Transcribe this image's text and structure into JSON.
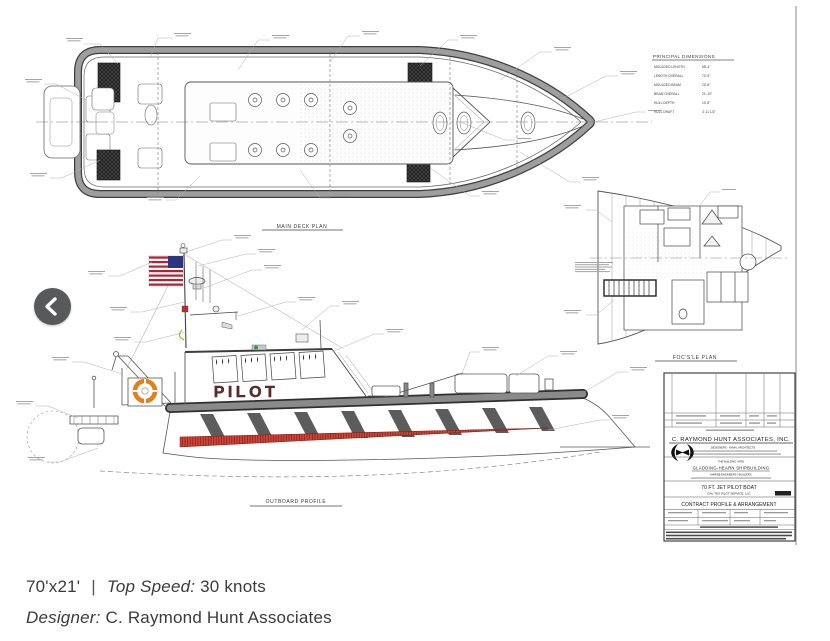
{
  "carousel": {
    "prev_icon": "chevron-left"
  },
  "caption": {
    "dimensions": "70'x21'",
    "separator": "|",
    "top_speed_label": "Top Speed:",
    "top_speed_value": "30 knots",
    "designer_label": "Designer:",
    "designer_value": "C. Raymond Hunt Associates"
  },
  "drawing": {
    "views": {
      "main_deck_plan": "MAIN DECK PLAN",
      "outboard_profile": "OUTBOARD PROFILE",
      "focsle_plan": "FOC'S'LE PLAN"
    },
    "hull_marking": "PILOT",
    "principal_dimensions": {
      "title": "PRINCIPAL DIMENSIONS",
      "rows": [
        {
          "label": "MOULDED LENGTH",
          "value": "68'-4\""
        },
        {
          "label": "LENGTH OVERALL",
          "value": "70'-9\""
        },
        {
          "label": "MOULDED BEAM",
          "value": "20'-8\""
        },
        {
          "label": "BEAM OVERALL",
          "value": "21'-10\""
        },
        {
          "label": "HULL DEPTH",
          "value": "10'-8\""
        },
        {
          "label": "HULL DRAFT",
          "value": "3'-11 1/2\""
        }
      ]
    },
    "title_block": {
      "firm": "C. RAYMOND HUNT ASSOCIATES, INC.",
      "firm_subtitle": "DESIGNERS - NAVAL ARCHITECTS",
      "builder_heading": "THE BUILDING YARD",
      "builder": "GLADDING-HEARN SHIPBUILDING",
      "builder_subtitle": "MARINE ENGINEERS / BUILDERS",
      "project": "70 FT. JET PILOT BOAT",
      "client": "GAL-TEX PILOT SERVICE, LLC",
      "sheet_title": "CONTRACT PROFILE & ARRANGEMENT"
    },
    "colors": {
      "accent_red": "#d93425",
      "line": "#4a4a4a",
      "fender_gray": "#8f8f8f",
      "flag_blue": "#2d3580",
      "flag_red": "#b22234",
      "life_ring_orange": "#e0801f",
      "nav_light_green": "#2e9e3a"
    }
  }
}
